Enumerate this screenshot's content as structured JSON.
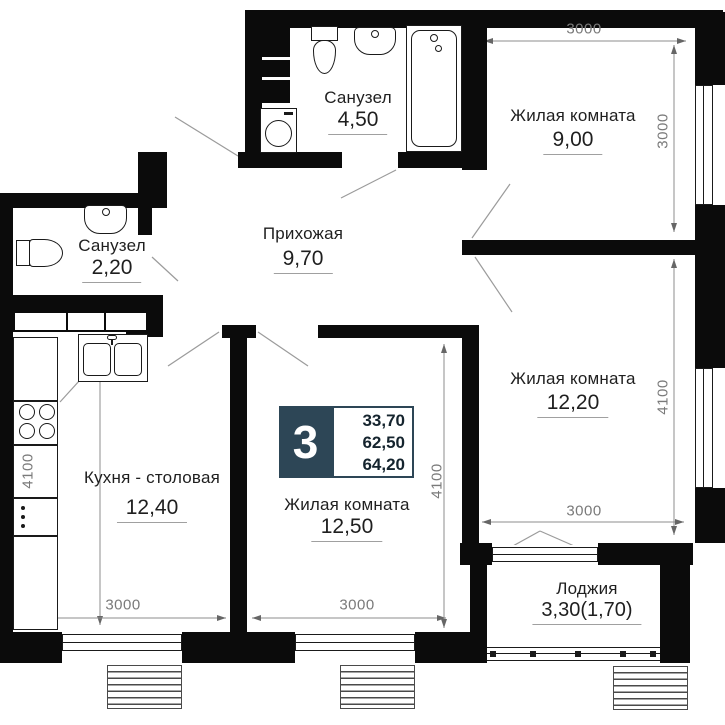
{
  "rooms": [
    {
      "key": "bathroom-top",
      "name": "Санузел",
      "area": "4,50"
    },
    {
      "key": "living-room-9",
      "name": "Жилая комната",
      "area": "9,00"
    },
    {
      "key": "bathroom-left",
      "name": "Санузел",
      "area": "2,20"
    },
    {
      "key": "hallway",
      "name": "Прихожая",
      "area": "9,70"
    },
    {
      "key": "living-room-12-2",
      "name": "Жилая комната",
      "area": "12,20"
    },
    {
      "key": "kitchen",
      "name": "Кухня - столовая",
      "area": "12,40"
    },
    {
      "key": "living-room-12-5",
      "name": "Жилая комната",
      "area": "12,50"
    },
    {
      "key": "loggia",
      "name": "Лоджия",
      "area": "3,30(1,70)"
    }
  ],
  "badge": {
    "rooms_count": "3",
    "values": [
      "33,70",
      "62,50",
      "64,20"
    ],
    "accent_color": "#2d4656"
  },
  "dimensions": {
    "top": "3000",
    "right_upper": "3000",
    "right_lower": "4100",
    "r1220_bottom": "3000",
    "kitchen_left": "4100",
    "kitchen_bottom": "3000",
    "r1250_bottom": "3000",
    "r1250_right": "4100"
  },
  "icons": [
    "toilet-icon",
    "sink-icon",
    "bathtub-icon",
    "washing-machine-icon",
    "stove-icon",
    "kitchen-sink-icon",
    "duct-shaft",
    "wardrobe",
    "radiator",
    "window",
    "balcony-railing"
  ],
  "colors": {
    "wall": "#0b0b0b",
    "dim_text": "#7a7a7a",
    "label_text": "#1f1f1f",
    "accent": "#2d4656"
  }
}
